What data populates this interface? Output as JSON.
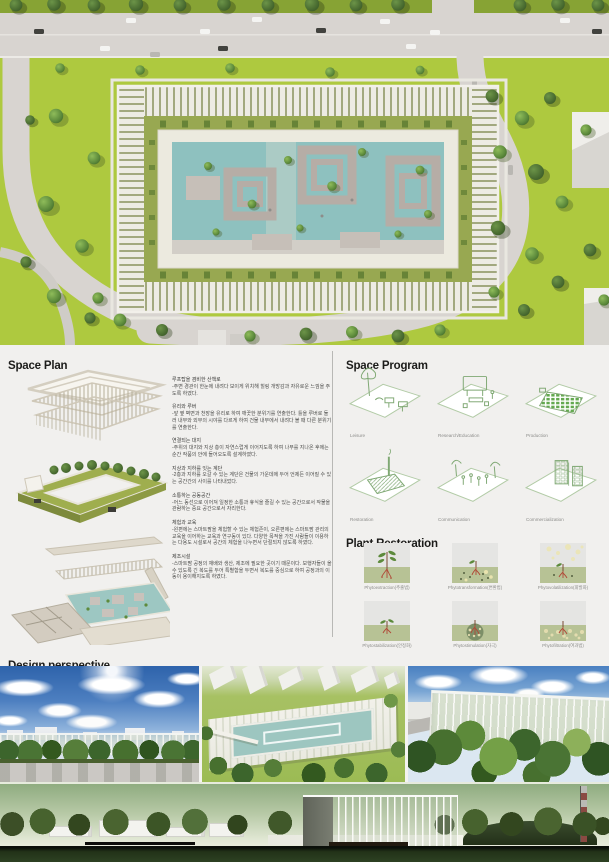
{
  "colors": {
    "grass": "#aec93f",
    "road": "#d8d4d0",
    "courtyard_pool": "#8ec1bf",
    "panel_bg": "#f1f0ee",
    "heading_text": "#1c1c1a",
    "body_text": "#4c4c4a",
    "label_text": "#8d8d8b",
    "program_line_green": "#7fa873",
    "plant_soil_green": "#b7c295",
    "plant_sky_gray": "#e5e5e3"
  },
  "space_plan": {
    "title": "Space Plan",
    "paragraphs": [
      {
        "heading": "루프탑을 겸비한 산책로",
        "body": "-주변 경관이 한눈에 내려다 보이게 위치해 힐링 개방감과 자유로운 느낌을 주도록 하였다."
      },
      {
        "heading": "유리와 루버",
        "body": "-앞 옆 벽면과 천장을 유리로 하여 깨끗한 분위기를 연출한다. 틀을 루버로 둘러 내부와 외부의 시야를 다르게 하여 건물 내부에서 내려다 볼 때 다른 분위기를 연출한다."
      },
      {
        "heading": "연결되는 대지",
        "body": "-주위의 대지와 지상 층이 자연스럽게 이어지도록 하여 나무를 지나온 후에는 순간 작품의 안에 들어오도록 설계하였다."
      },
      {
        "heading": "지상과 지하를 잇는 계단",
        "body": "-2층과 지하를 오갈 수 있는 계단은 건물의 가운데에 두어 언제든 이어질 수 있는 공간간의 사이를 나타내었다."
      },
      {
        "heading": "소통하는 공동공간",
        "body": "-어느 동선으로 이어져 일정한 소통과 휴식을 즐길 수 있는 공간으로서 작물을 관람하는 중요 공간으로서 자리한다."
      },
      {
        "heading": "체험과 교육",
        "body": "-왼편에는 스마트팜을 체험할 수 있는 체험존이, 오른편에는 스마트팜 관리의 교육을 이어하는 교육과 연구동이 있다. 다양한 목적을 가진 사람들이 이용하는 다용도 시설로서 공간의 체험을 나누면서 단절되지 않도록 하였다."
      },
      {
        "heading": "제조시설",
        "body": "-스마트팜 공정의 재배와 생산, 제조에 필요한 곳이기 때문이다. 보행자들이 올 수 있도록 긴 복도를 두어 특별함을 두면서 복도를 중심으로 하여 공정과의 이동이 용이해지도록 하였다."
      }
    ]
  },
  "space_program": {
    "title": "Space Program",
    "items": [
      {
        "label": "Leisure"
      },
      {
        "label": "Research/Education"
      },
      {
        "label": "Production"
      },
      {
        "label": "Restoration"
      },
      {
        "label": "Communication"
      },
      {
        "label": "Commercialization"
      }
    ]
  },
  "plant_restoration": {
    "title": "Plant Restoration",
    "items": [
      {
        "label": "Phytoextraction(추출법)"
      },
      {
        "label": "Phytotransformation(변환법)"
      },
      {
        "label": "Phytovolatilization(휘발화)"
      },
      {
        "label": "Phytostabilization(안정화)"
      },
      {
        "label": "Phytostimulation(자극)"
      },
      {
        "label": "Phytofiltration(여과법)"
      }
    ]
  },
  "design_perspective": {
    "title": "Design perspective",
    "images": [
      {
        "name": "street-level-view"
      },
      {
        "name": "aerial-courtyard-view"
      },
      {
        "name": "garden-eye-level-view"
      }
    ]
  }
}
